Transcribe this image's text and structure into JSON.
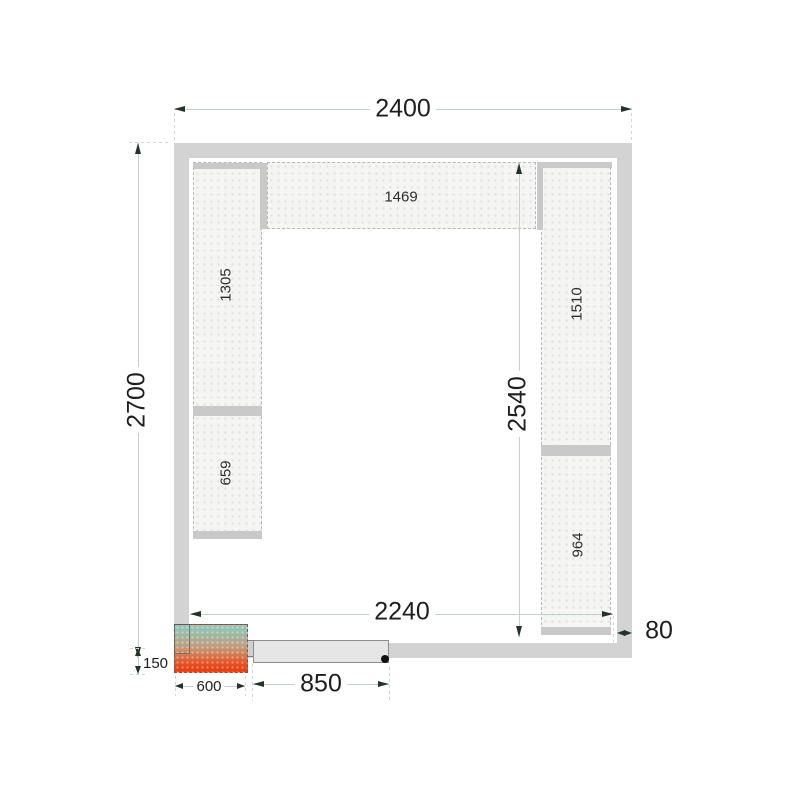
{
  "dimensions": {
    "outer_width": "2400",
    "outer_depth": "2700",
    "inner_width": "2240",
    "inner_depth": "2540",
    "wall_thickness": "80",
    "door_width": "850",
    "unit_width": "600",
    "unit_protrusion": "150"
  },
  "shelves": {
    "top": "1469",
    "left_upper": "1305",
    "left_lower": "659",
    "right_upper": "1510",
    "right_lower": "964"
  },
  "colors": {
    "wall": "#d3d3d3",
    "shelf_fill": "#f5f5f4",
    "shelf_border": "#b8b8b5",
    "bracket": "#c9c9c9",
    "dimension_line": "#c4d1cb",
    "arrowhead": "#26332b",
    "text": "#1e1e1e",
    "unit_gradient_top": "#8ec8c0",
    "unit_gradient_bottom": "#ec3c10",
    "door_leaf": "#e6e6e6",
    "door_dot": "#111111"
  }
}
